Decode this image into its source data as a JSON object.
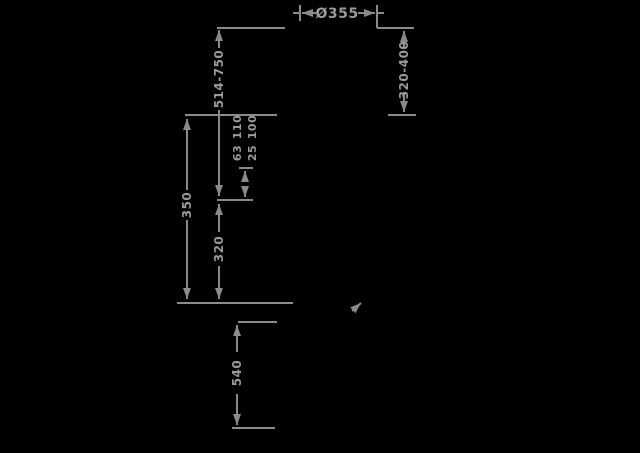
{
  "diagram": {
    "kind": "technical-dimension-drawing",
    "colors": {
      "background": "#000000",
      "line": "#8a8a8a",
      "text": "#9a9a9a"
    },
    "dimensions": {
      "top_diameter": "Ø355",
      "right_range": "320-400",
      "upper_height_range": "514-750",
      "mid_upper_line1": "110",
      "mid_upper_line2": "100",
      "mid_lower_line1": "63",
      "mid_lower_line2": "25",
      "left_height": "350",
      "center_lower_height": "320",
      "base_height": "540"
    }
  }
}
